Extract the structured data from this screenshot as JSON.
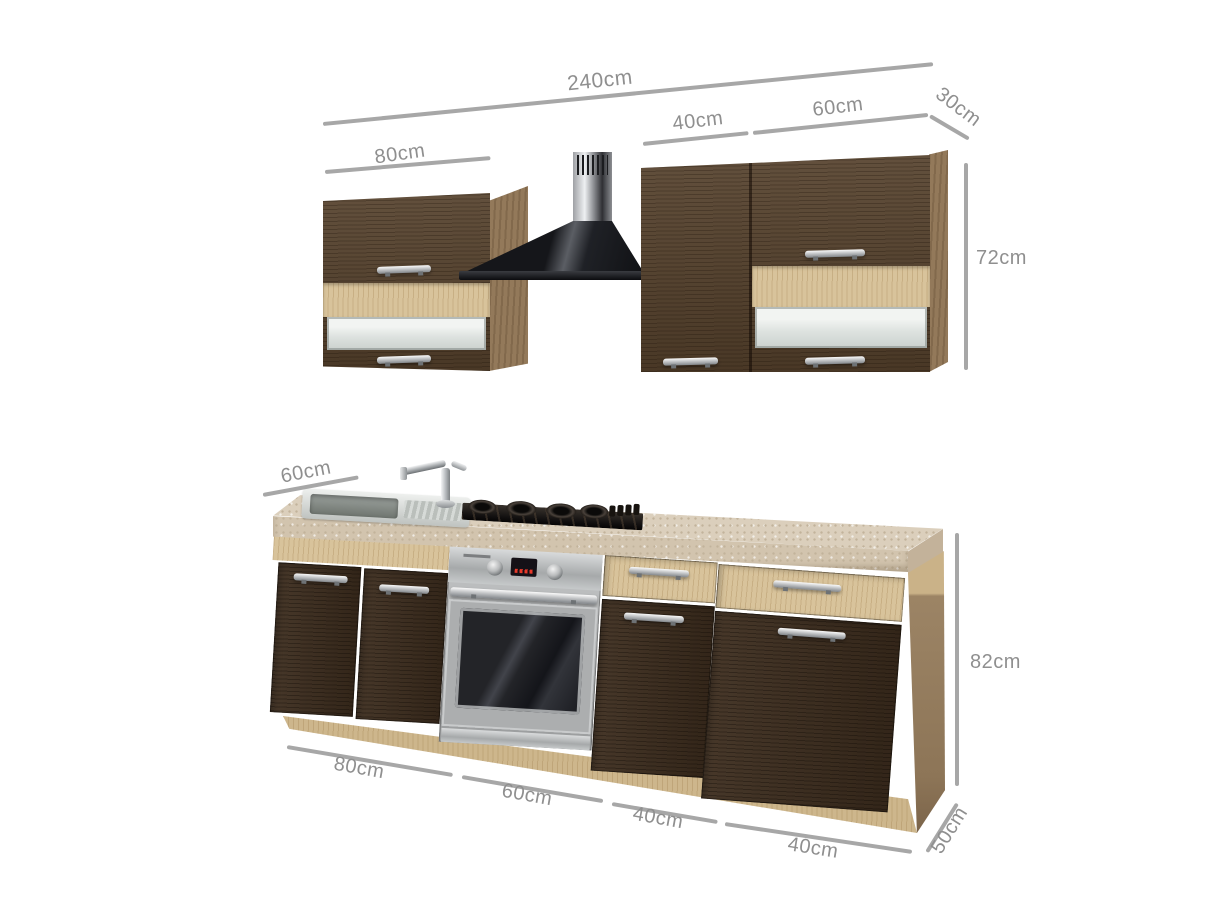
{
  "dims": {
    "total_top": "240cm",
    "wall_left": "80cm",
    "wall_door": "40cm",
    "wall_glass": "60cm",
    "wall_depth": "30cm",
    "wall_height": "72cm",
    "worktop_depth": "60cm",
    "base_height": "82cm",
    "base_sink": "80cm",
    "base_oven": "60cm",
    "base_drawer1": "40cm",
    "base_drawer2": "40cm",
    "base_depth": "50cm"
  },
  "colors": {
    "dim_line": "#a7a7a7",
    "dim_text": "#8f8f8f",
    "dark_wood": "#4a3726",
    "light_wood": "#d8c39b",
    "carcass_wood": "#93795a",
    "worktop": "#d8ccb9",
    "stainless_steel": "#b9bcbd",
    "hood_black": "#17181c",
    "background": "#ffffff"
  }
}
